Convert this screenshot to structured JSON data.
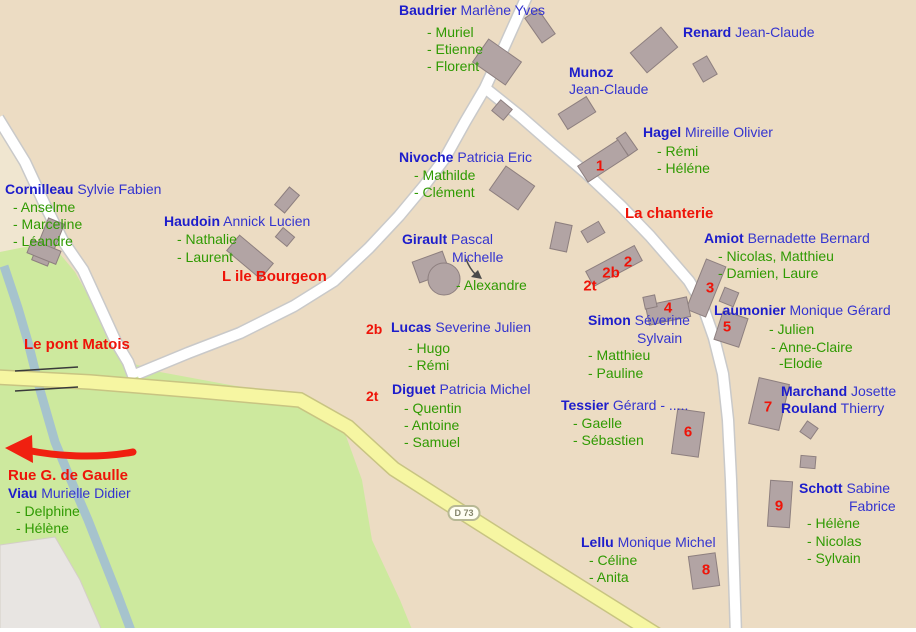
{
  "map": {
    "road_ref": "D 73",
    "colors": {
      "land": "#ecdcc3",
      "green_area": "#cde99e",
      "gray_area": "#e8e5e2",
      "river": "#a6c3cd",
      "white_road": "#ffffff",
      "yellow_road": "#f6f6a2",
      "building": "#b2a4a4",
      "surname_blue": "#1d1dcb",
      "given_blue": "#3434cf",
      "children_green": "#2f9a02",
      "annotation_red": "#ee1409"
    }
  },
  "places": {
    "ile_bourgeon": "L ile Bourgeon",
    "chanterie": "La chanterie",
    "pont_matois": "Le pont Matois",
    "rue_gaulle": "Rue G. de Gaulle"
  },
  "markers": {
    "m1": "1",
    "m2": "2",
    "m2b": "2b",
    "m2t": "2t",
    "m3": "3",
    "m4": "4",
    "m5": "5",
    "m6": "6",
    "m7": "7",
    "m8": "8",
    "m9": "9"
  },
  "families": {
    "baudrier": {
      "surname": "Baudrier",
      "given": "Marlène Yves",
      "children": [
        "- Muriel",
        "- Etienne",
        "- Florent"
      ]
    },
    "renard": {
      "surname": "Renard",
      "given": "Jean-Claude"
    },
    "munoz": {
      "surname": "Munoz",
      "given2": "Jean-Claude"
    },
    "hagel": {
      "surname": "Hagel",
      "given": "Mireille Olivier",
      "children": [
        "- Rémi",
        "- Héléne"
      ]
    },
    "nivoche": {
      "surname": "Nivoche",
      "given": "Patricia Eric",
      "children": [
        "- Mathilde",
        "- Clément"
      ]
    },
    "cornilleau": {
      "surname": "Cornilleau",
      "given": "Sylvie Fabien",
      "children": [
        "- Anselme",
        "- Marceline",
        "- Léandre"
      ]
    },
    "haudoin": {
      "surname": "Haudoin",
      "given": "Annick Lucien",
      "children": [
        "- Nathalie",
        "- Laurent"
      ]
    },
    "girault": {
      "surname": "Girault",
      "given": "Pascal",
      "given2": "Michelle",
      "children": [
        "- Alexandre"
      ]
    },
    "amiot": {
      "surname": "Amiot",
      "given": "Bernadette Bernard",
      "children": [
        "- Nicolas, Matthieu",
        "- Damien, Laure"
      ]
    },
    "laumonier": {
      "surname": "Laumonier",
      "given": "Monique Gérard",
      "children": [
        "- Julien",
        "- Anne-Claire",
        "-Elodie"
      ]
    },
    "simon": {
      "surname": "Simon",
      "given": "Séverine",
      "given2": "Sylvain",
      "children": [
        "- Matthieu",
        "- Pauline"
      ]
    },
    "lucas": {
      "prefix": "2b",
      "surname": "Lucas",
      "given": "Severine Julien",
      "children": [
        "- Hugo",
        "- Rémi"
      ]
    },
    "diguet": {
      "prefix": "2t",
      "surname": "Diguet",
      "given": "Patricia Michel",
      "children": [
        "- Quentin",
        "- Antoine",
        "- Samuel"
      ]
    },
    "tessier": {
      "surname": "Tessier",
      "given": "Gérard - .....",
      "children": [
        "- Gaelle",
        "- Sébastien"
      ]
    },
    "marchand": {
      "surname": "Marchand",
      "given": "Josette"
    },
    "rouland": {
      "surname": "Rouland",
      "given": "Thierry"
    },
    "schott": {
      "surname": "Schott",
      "given": "Sabine",
      "given2": "Fabrice",
      "children": [
        "- Hélène",
        "- Nicolas",
        "- Sylvain"
      ]
    },
    "lellu": {
      "surname": "Lellu",
      "given": "Monique Michel",
      "children": [
        "- Céline",
        "- Anita"
      ]
    },
    "viau": {
      "surname": "Viau",
      "given": "Murielle Didier",
      "children": [
        "- Delphine",
        "- Hélène"
      ]
    }
  }
}
